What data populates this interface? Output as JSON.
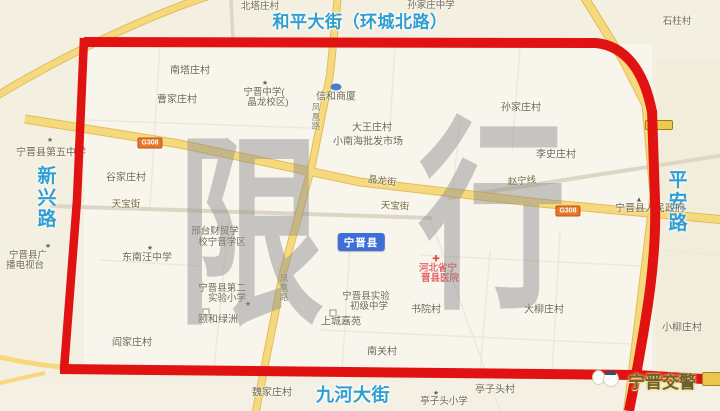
{
  "meta": {
    "description_hint": "Ningjin county traffic-restriction zone map"
  },
  "colors": {
    "restriction_red": "#e01212",
    "road_yellow": "#f6d97e",
    "street_name_blue": "#2f9ed2",
    "county_box_blue": "#3f6fd6",
    "hospital_red": "#e36464",
    "watermark_gray": "#8f8f8f",
    "map_background": "#f5f1e5"
  },
  "icons": {
    "school_star": "★",
    "hospital_cross": "✚",
    "government_marker": "▲"
  },
  "watermark": {
    "char1": "限",
    "char2": "行"
  },
  "main_streets": {
    "top": "和平大街（环城北路）",
    "left": "新兴路",
    "right": "平安路",
    "bottom": "九河大街"
  },
  "road_names": {
    "g308": "G308",
    "jinglong_street": "晶龙街",
    "zhaoning_line": "赵宁线",
    "tianbao_street": "天宝街",
    "fenghuang_road": "凤凰路"
  },
  "labels": {
    "beitazhuang_village": "北塔庄村",
    "sunjiazhuang_middle_school": "孙家庄中学",
    "shizhu_village": "石柱村",
    "nantazhuang_village": "南塔庄村",
    "caojiazhuang_village": "曹家庄村",
    "ningjin_middle_line1": "宁晋中学(",
    "ningjin_middle_line2": "晶龙校区)",
    "xinhe_mall": "信和商厦",
    "sunjiazhuang_village": "孙家庄村",
    "dawangzhuang_village": "大王庄村",
    "xiaonanhai_market": "小南海批发市场",
    "fifth_middle_school": "宁晋县第五中学",
    "gujiazhuang_village": "谷家庄村",
    "lishizhuang_village": "李史庄村",
    "county_badge": "宁晋县",
    "county_government": "宁晋县人民政府",
    "xingtai_finance_school_line1": "邢台财贸学",
    "xingtai_finance_school_line2": "校宁晋学区",
    "dongnanwang_middle_school": "东南汪中学",
    "tv_station_line1": "宁晋县广",
    "tv_station_line2": "播电视台",
    "second_experimental_primary_line1": "宁晋县第二",
    "second_experimental_primary_line2": "实验小学",
    "yihe_lvzhou": "颐和绿洲",
    "experimental_junior_middle_line1": "宁晋县实验",
    "experimental_junior_middle_line2": "初级中学",
    "shangcheng_jiayuan": "上城嘉苑",
    "hospital_line1": "河北省宁",
    "hospital_line2": "晋县医院",
    "shuyuan_village": "书院村",
    "daliuzhuang_village": "大柳庄村",
    "xiaoliuzhuang_village": "小柳庄村",
    "nanguan_village": "南关村",
    "yanjiazhuang_village": "阎家庄村",
    "weijiazhuang_village": "魏家庄村",
    "tingzitou_village": "亭子头村",
    "tingzitou_primary_school": "亭子头小学",
    "police_logo": "宁晋交警"
  }
}
